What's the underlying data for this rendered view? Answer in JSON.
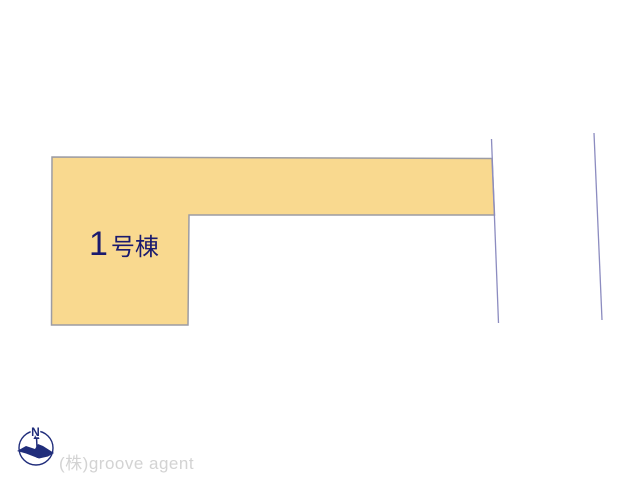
{
  "page": {
    "background_color": "#ffffff"
  },
  "site_plan": {
    "building": {
      "label_number": "1",
      "label_suffix": "号棟",
      "fill_color": "#f9d98f",
      "outline_color": "#9c9ca4",
      "label_color": "#1a1a6e"
    },
    "boundary_lines": {
      "color": "#8c8cc0",
      "count": 2
    }
  },
  "compass": {
    "north_label": "N",
    "color": "#202d7b"
  },
  "footer": {
    "company_text": "(株)groove agent",
    "text_color": "#d3d3d3"
  }
}
